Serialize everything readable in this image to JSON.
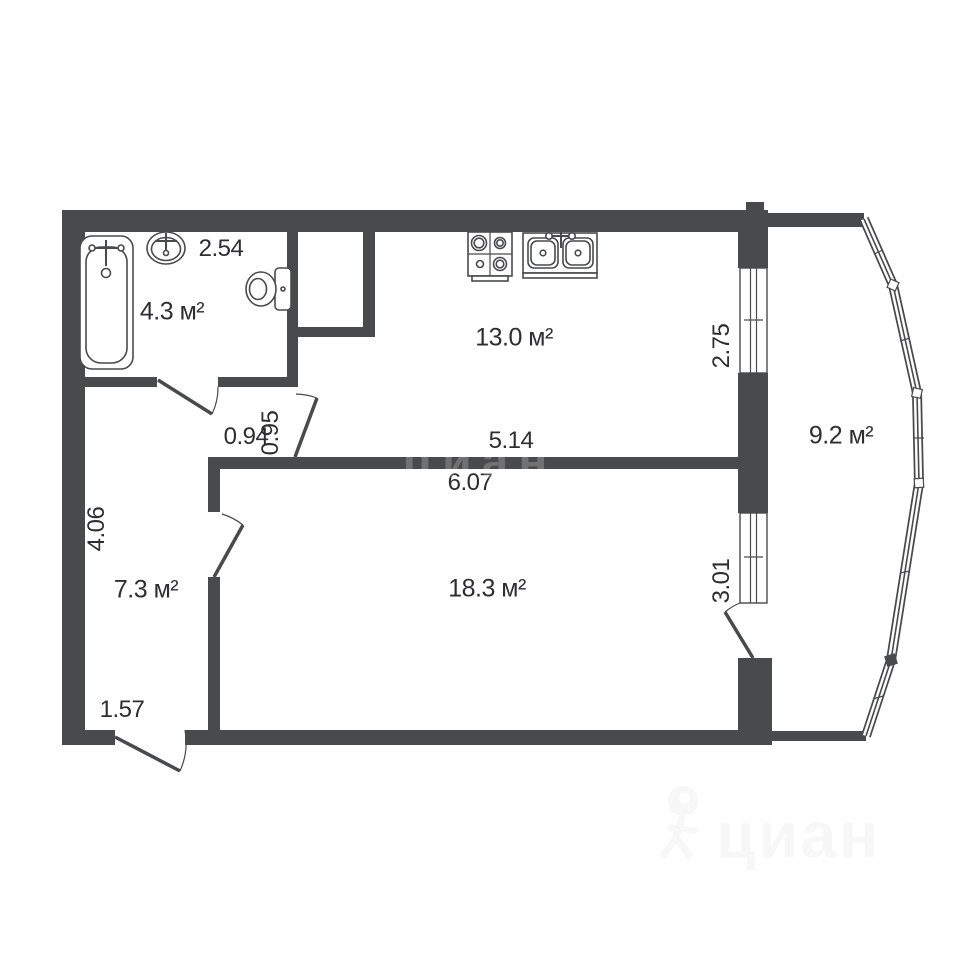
{
  "floorplan": {
    "rooms": [
      {
        "name": "bathroom",
        "area": "4.3 м²"
      },
      {
        "name": "kitchen",
        "area": "13.0 м²"
      },
      {
        "name": "hallway",
        "area": "7.3 м²"
      },
      {
        "name": "living-room",
        "area": "18.3 м²"
      },
      {
        "name": "balcony",
        "area": "9.2 м²"
      }
    ],
    "dimensions": {
      "bathroom_width": "2.54",
      "passage_a": "0.94",
      "passage_b": "0.95",
      "kitchen_width": "5.14",
      "kitchen_depth": "2.75",
      "living_width": "6.07",
      "living_depth": "3.01",
      "hallway_depth": "4.06",
      "hallway_width": "1.57"
    },
    "watermark": {
      "brand": "циан"
    },
    "colors": {
      "wall": "#494a4b",
      "text": "#2e2e30",
      "background": "#ffffff",
      "watermark": "#f7f7f7"
    }
  }
}
